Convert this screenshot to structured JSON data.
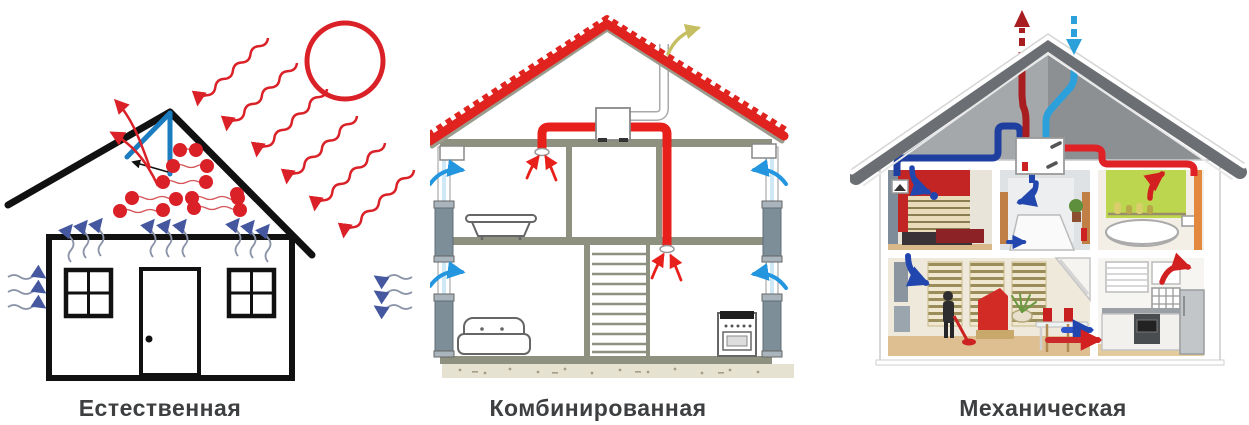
{
  "figure": {
    "title": "Types of house ventilation illustration",
    "background": "#ffffff"
  },
  "panels": [
    {
      "id": "natural-ventilation",
      "label": "Естественная",
      "elements": [
        "sun-icon",
        "solar-radiation-wavy-arrows",
        "roof-ridge-vent",
        "vent-exhaust-arrows",
        "heat-particles",
        "rising-warm-air-arrows",
        "window-infiltration-arrows-left",
        "window-infiltration-arrows-right",
        "house-outline",
        "front-door",
        "four-pane-window-left",
        "four-pane-window-right"
      ]
    },
    {
      "id": "combined-ventilation",
      "label": "Комбинированная",
      "elements": [
        "red-tiled-roof",
        "attic-exhaust-fan-unit",
        "roof-chimney-outlet",
        "exhaust-air-arrow-yellow",
        "red-exhaust-duct",
        "ceiling-extract-diffuser-upper",
        "floor-extract-diffuser-lower",
        "extract-air-arrows-red",
        "wall-supply-vent-left",
        "wall-supply-vent-right",
        "supply-air-arrows-blue",
        "bathtub",
        "sofa",
        "stove",
        "staircase",
        "two-storey-structure",
        "ground-gravel"
      ]
    },
    {
      "id": "mechanical-ventilation",
      "label": "Механическая",
      "elements": [
        "gray-roof",
        "heat-recovery-unit",
        "fresh-air-intake-arrow-blue",
        "exhaust-outlet-arrow-red",
        "supply-duct-dark-blue",
        "intake-duct-cyan",
        "extract-duct-red",
        "orange-riser-duct",
        "bedroom",
        "hallway",
        "bathroom",
        "living-room",
        "kitchen",
        "room-supply-arrows-blue",
        "room-extract-arrows-red",
        "floor-transfer-arrows",
        "person-vacuuming",
        "dining-table",
        "bathtub-round",
        "fridge",
        "oven"
      ]
    }
  ],
  "colors": {
    "red": "#da2128",
    "deep_red": "#a81d20",
    "roof_red": "#e0231f",
    "blue_arrowhead": "#44579f",
    "wavy_tail_gray": "#8a93a8",
    "sky_blue": "#2496e0",
    "cyan_duct": "#2ba0da",
    "dark_blue_duct": "#1e3f9f",
    "room_arrow_blue": "#2146ae",
    "vent_flap_blue": "#1b7dc0",
    "olive_structure": "#8e9080",
    "yellow_arrow": "#c5bf62",
    "orange_duct": "#e2893f",
    "green_wall": "#bcd64f",
    "bedroom_red_wall": "#c32524",
    "roof_dark_gray": "#6b6e72",
    "label_text": "#3d3f41",
    "background": "#ffffff"
  }
}
